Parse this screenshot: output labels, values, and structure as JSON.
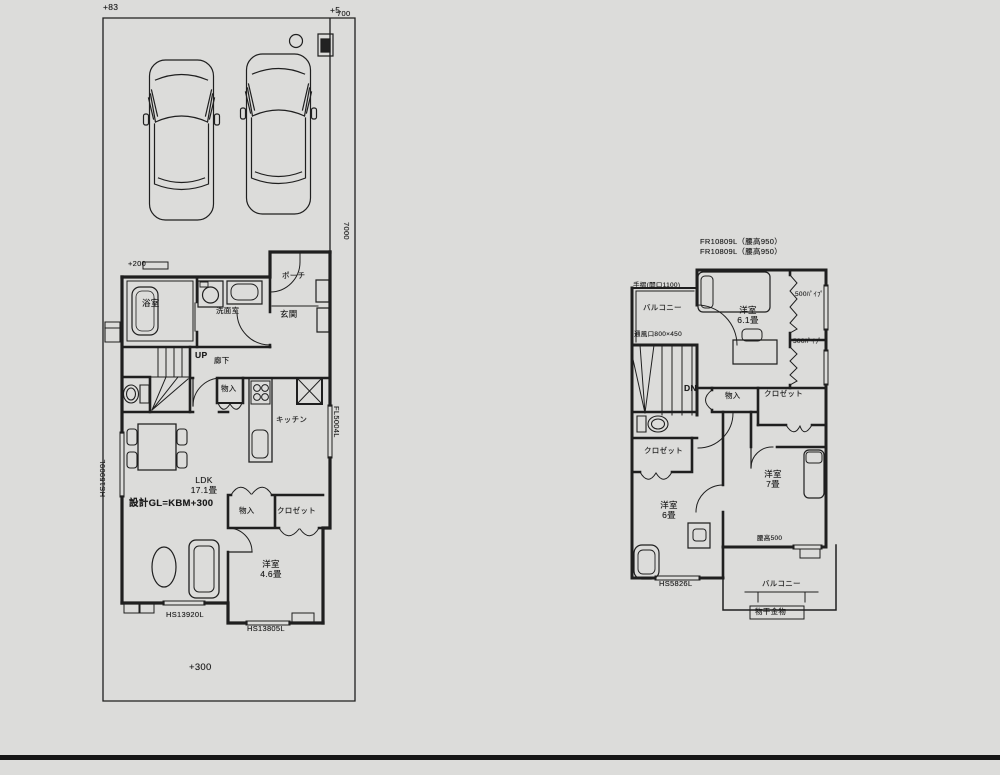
{
  "site": {
    "dim_left": "+83",
    "dim_right": "+5",
    "dim_width": "700",
    "dim_depth": "7000",
    "bench_mark": "+200",
    "gl_note": "設計GL=KBM+300",
    "level_note": "+300"
  },
  "floor1": {
    "rooms": {
      "bath": "浴室",
      "washroom": "洗面室",
      "porch": "ポーチ",
      "entrance": "玄関",
      "stairs": "UP",
      "hall": "廊下",
      "storage_hall": "物入",
      "kitchen": "キッチン",
      "ldk": "LDK\n17.1畳",
      "storage_ldk": "物入",
      "closet": "クロゼット",
      "bedroom": "洋室\n4.6畳"
    },
    "windows": {
      "left": "HS15909L",
      "bottom_left": "HS13920L",
      "bottom_right": "HS13805L",
      "right": "FL5004L"
    }
  },
  "floor2": {
    "notes": {
      "window_note1": "FR10809L（腰高950）",
      "window_note2": "FR10809L（腰高950）",
      "handrail": "手摺(開口1100)",
      "vent": "通風口800×450",
      "sill": "腰高500",
      "hanger": "物干金物"
    },
    "rooms": {
      "balcony_top": "バルコニー",
      "stairs": "DN",
      "bedroom1": "洋室\n6.1畳",
      "closet_pipe1": "500ﾊﾟｲﾌﾟ",
      "closet_pipe2": "500ﾊﾟｲﾌﾟ",
      "storage": "物入",
      "closet1": "クロゼット",
      "closet2": "クロゼット",
      "bedroom2": "洋室\n7畳",
      "bedroom3": "洋室\n6畳",
      "balcony_bottom": "バルコニー"
    },
    "windows": {
      "bottom": "HS5826L"
    }
  }
}
